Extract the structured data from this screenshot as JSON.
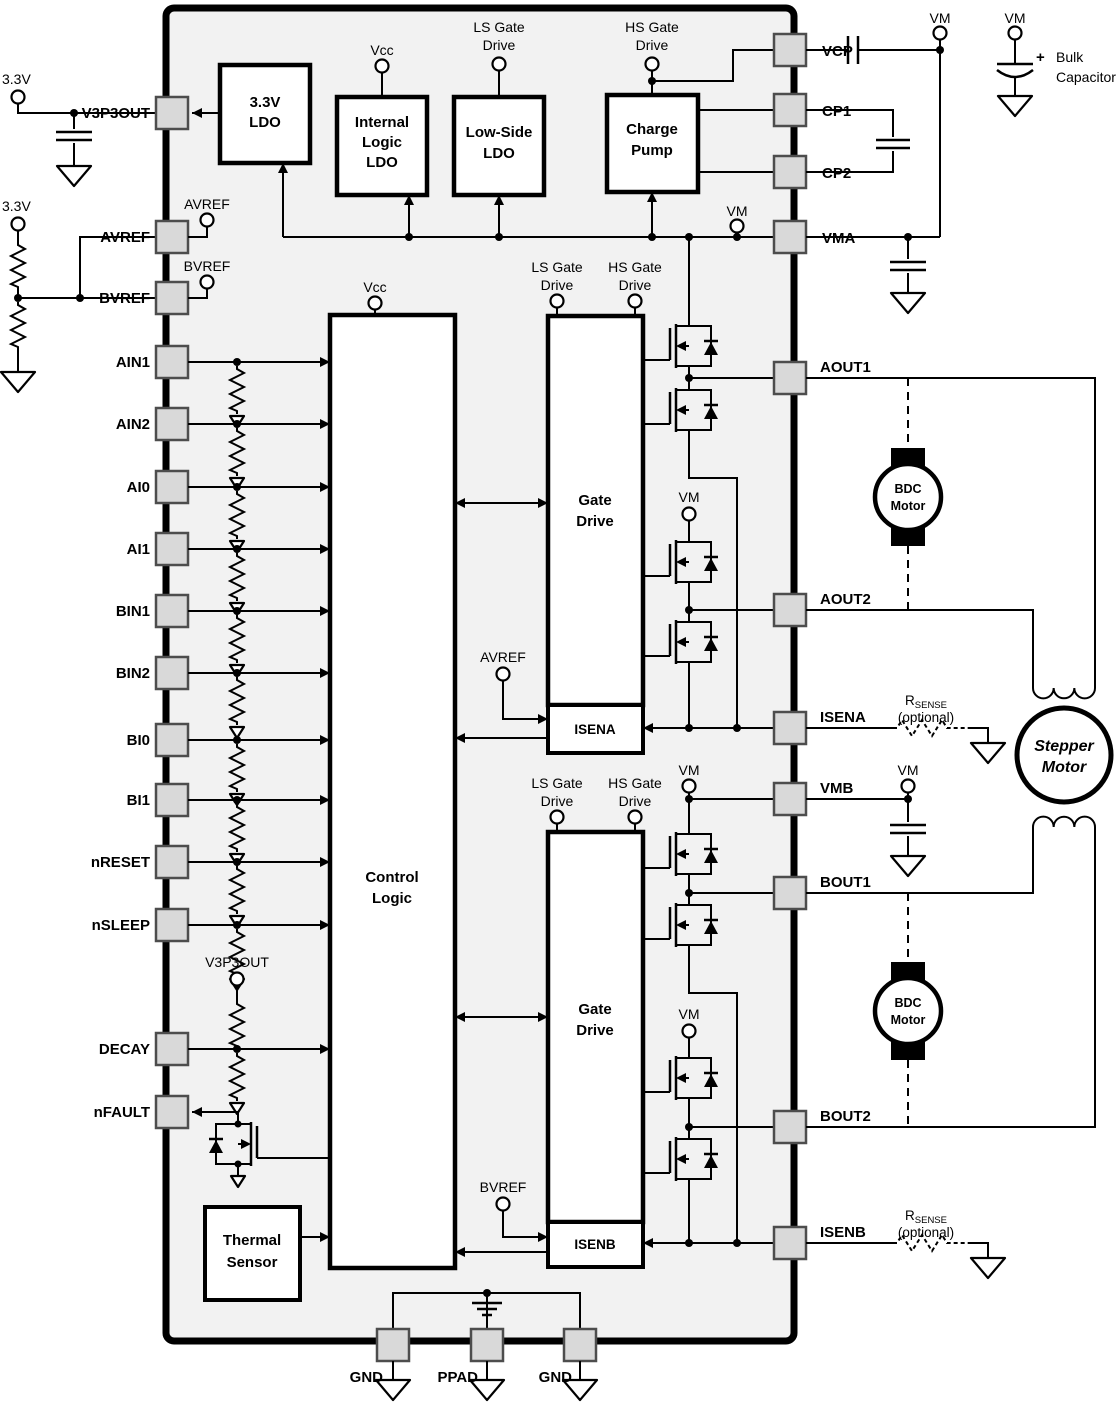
{
  "pins": {
    "left": [
      "V3P3OUT",
      "AVREF",
      "BVREF",
      "AIN1",
      "AIN2",
      "AI0",
      "AI1",
      "BIN1",
      "BIN2",
      "BI0",
      "BI1",
      "nRESET",
      "nSLEEP",
      "DECAY",
      "nFAULT"
    ],
    "right": [
      "VCP",
      "CP1",
      "CP2",
      "VMA",
      "AOUT1",
      "AOUT2",
      "ISENA",
      "VMB",
      "BOUT1",
      "BOUT2",
      "ISENB"
    ],
    "bottom": [
      "GND",
      "PPAD",
      "GND"
    ]
  },
  "blocks": {
    "ldo33": [
      "3.3V",
      "LDO"
    ],
    "int_logic_ldo": [
      "Internal",
      "Logic",
      "LDO"
    ],
    "low_side_ldo": [
      "Low-Side",
      "LDO"
    ],
    "charge_pump": [
      "Charge",
      "Pump"
    ],
    "control_logic": [
      "Control",
      "Logic"
    ],
    "gate_drive": [
      "Gate",
      "Drive"
    ],
    "isena": "ISENA",
    "isenb": "ISENB",
    "thermal": [
      "Thermal",
      "Sensor"
    ]
  },
  "terminals": {
    "vcc": "Vcc",
    "vm": "VM",
    "avref": "AVREF",
    "bvref": "BVREF",
    "v3p3out": "V3P3OUT",
    "ls_gate": [
      "LS Gate",
      "Drive"
    ],
    "hs_gate": [
      "HS Gate",
      "Drive"
    ]
  },
  "external": {
    "supply": "3.3V",
    "bulk_capacitor": [
      "Bulk",
      "Capacitor"
    ],
    "rsense_r": "R",
    "rsense_sub": "SENSE",
    "rsense_optional": "(optional)",
    "bdc_motor": [
      "BDC",
      "Motor"
    ],
    "stepper_motor": [
      "Stepper",
      "Motor"
    ]
  },
  "colors": {
    "chip_fill": "#f2f2f2",
    "pin_fill": "#d9d9d9",
    "line": "#000000"
  }
}
